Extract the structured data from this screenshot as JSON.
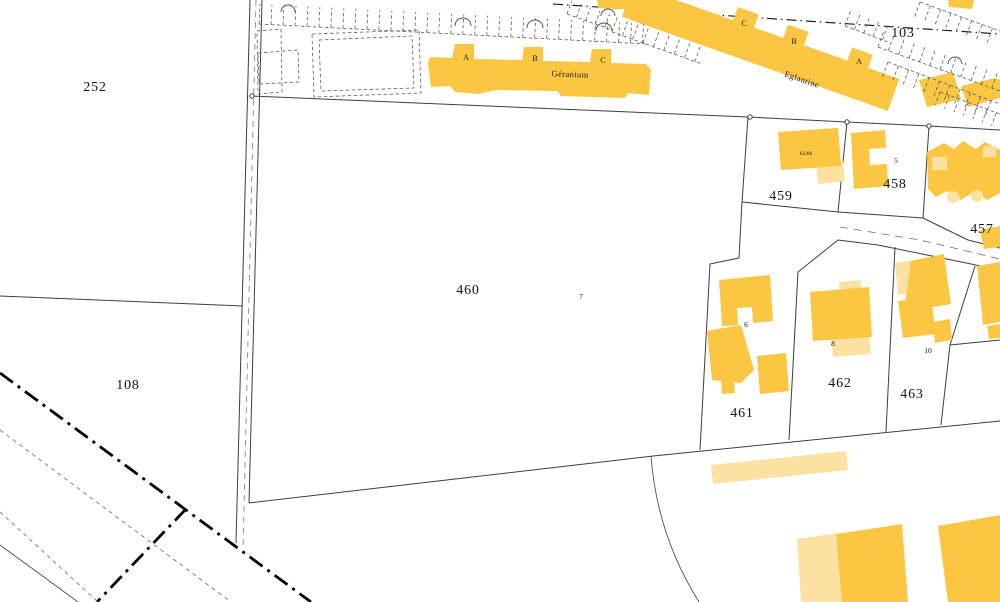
{
  "map": {
    "colors": {
      "building": "#FBC642",
      "annex": "#FCE2A2",
      "line": "#3F3F3F",
      "label": "#141414"
    },
    "parcels": [
      {
        "id": "252"
      },
      {
        "id": "108"
      },
      {
        "id": "460"
      },
      {
        "id": "461"
      },
      {
        "id": "462"
      },
      {
        "id": "463"
      },
      {
        "id": "459"
      },
      {
        "id": "458"
      },
      {
        "id": "457"
      },
      {
        "id": "103"
      }
    ],
    "residences": [
      {
        "name": "Géranium",
        "sections": [
          "A",
          "B",
          "C"
        ]
      },
      {
        "name": "Eglantine",
        "sections": [
          "C",
          "B",
          "A"
        ]
      }
    ],
    "house_numbers": [
      "5",
      "6",
      "7",
      "8",
      "10",
      "62/66"
    ]
  }
}
